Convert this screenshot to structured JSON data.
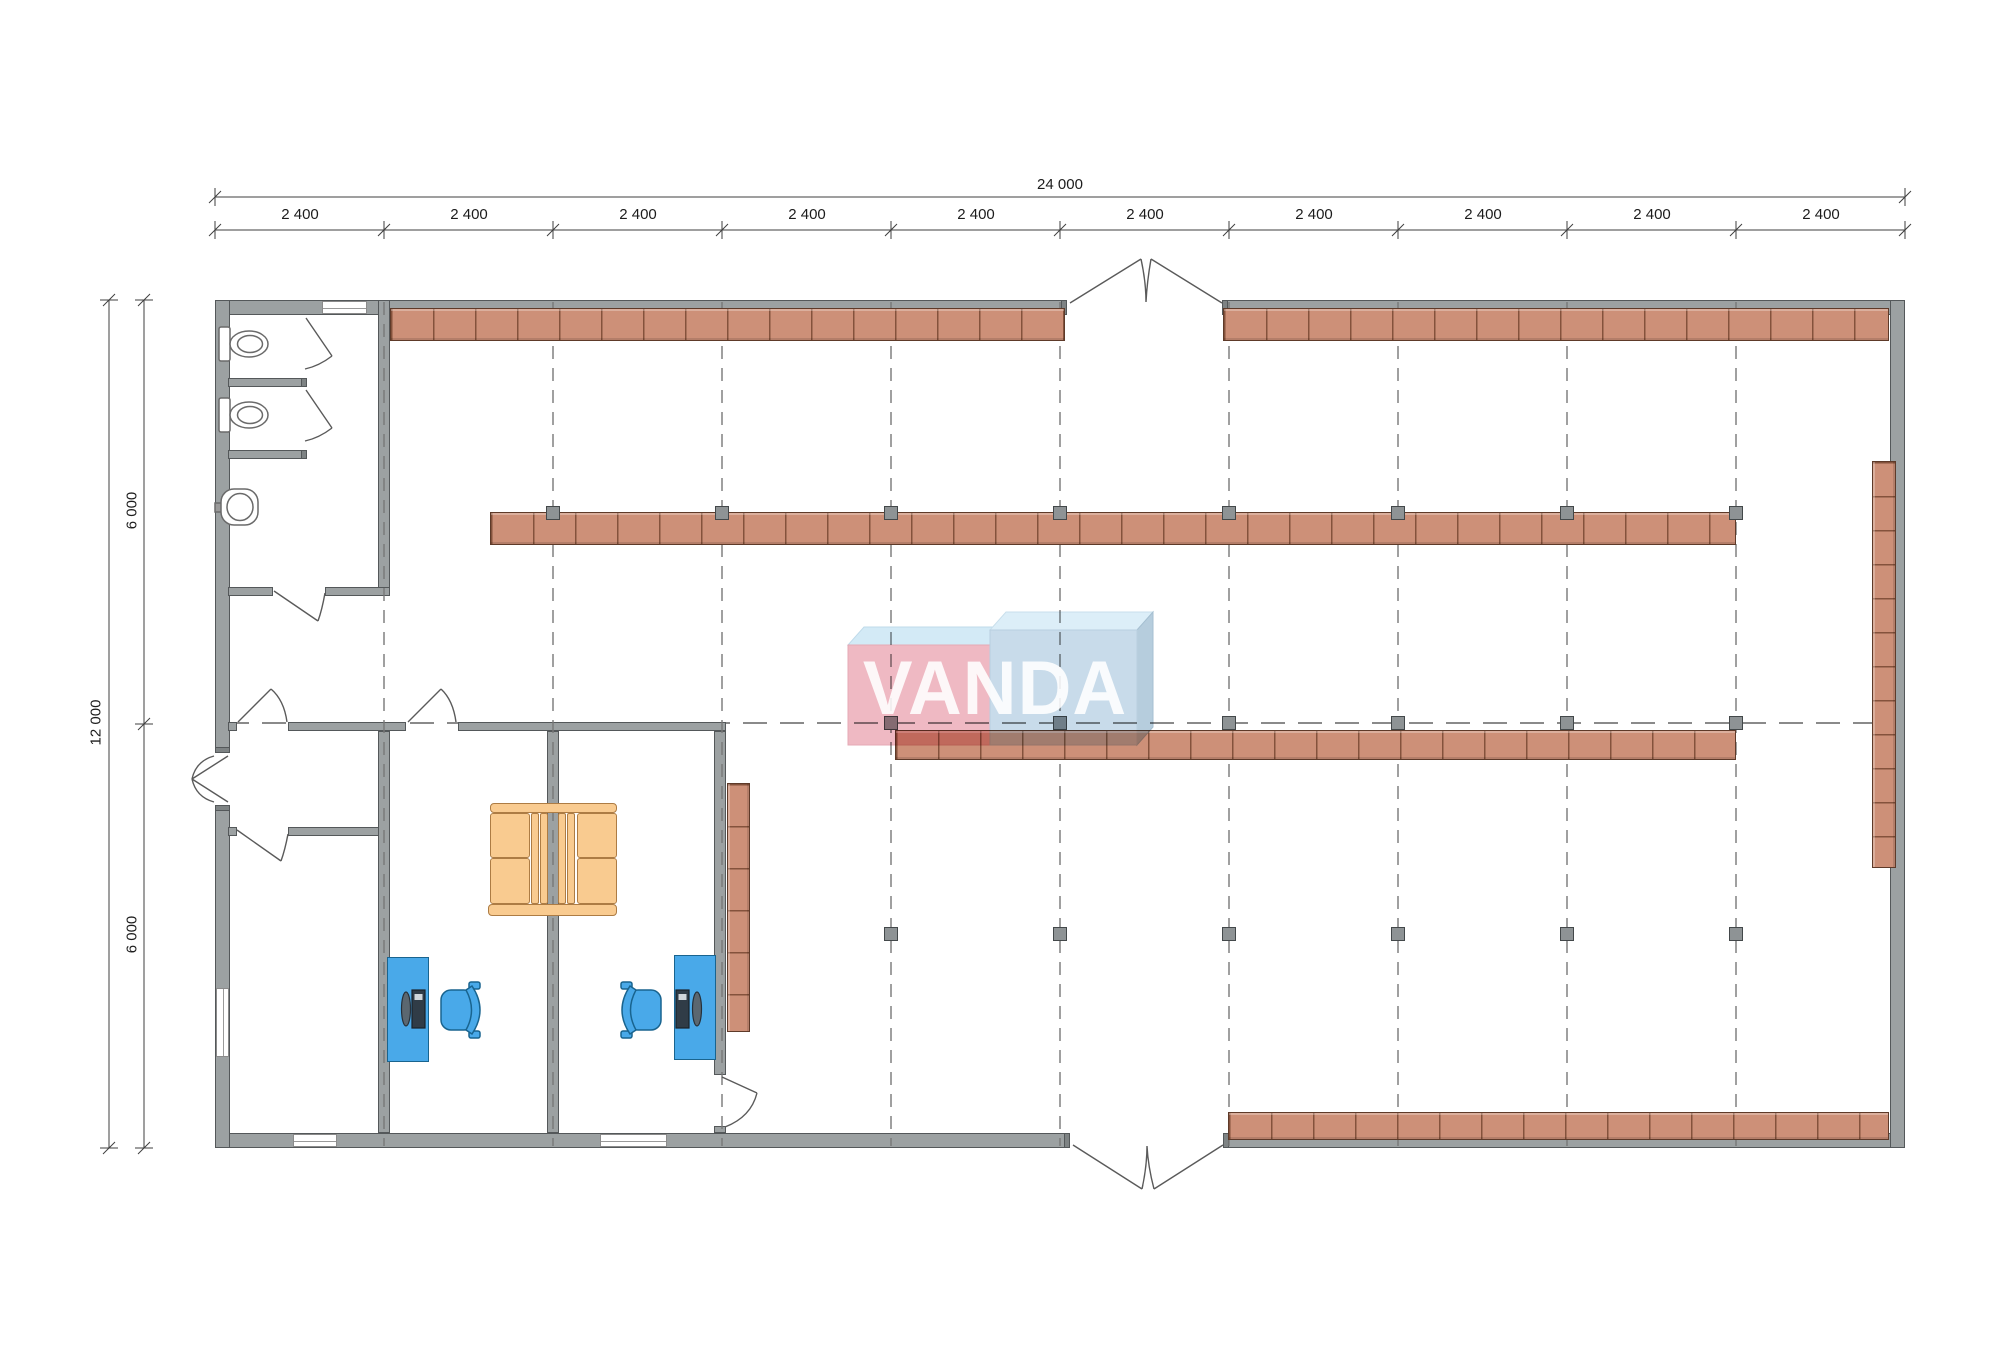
{
  "plan": {
    "logo_text": "VANDA"
  },
  "dimensions": {
    "total_width": "24 000",
    "total_height": "12 000",
    "bays": [
      "2 400",
      "2 400",
      "2 400",
      "2 400",
      "2 400",
      "2 400",
      "2 400",
      "2 400",
      "2 400",
      "2 400"
    ],
    "halves": [
      "6 000",
      "6 000"
    ]
  },
  "colors": {
    "wall": "#9ca1a2",
    "shelf": "#cd9078",
    "shelf_border": "#5e3a29",
    "column": "#8e9395",
    "furniture_blue": "#49a9e9",
    "sofa_orange": "#f9cb90",
    "logo_pink": "#eeb2bd",
    "logo_blue": "#c3d8e8",
    "grid_dash": "#787878"
  }
}
